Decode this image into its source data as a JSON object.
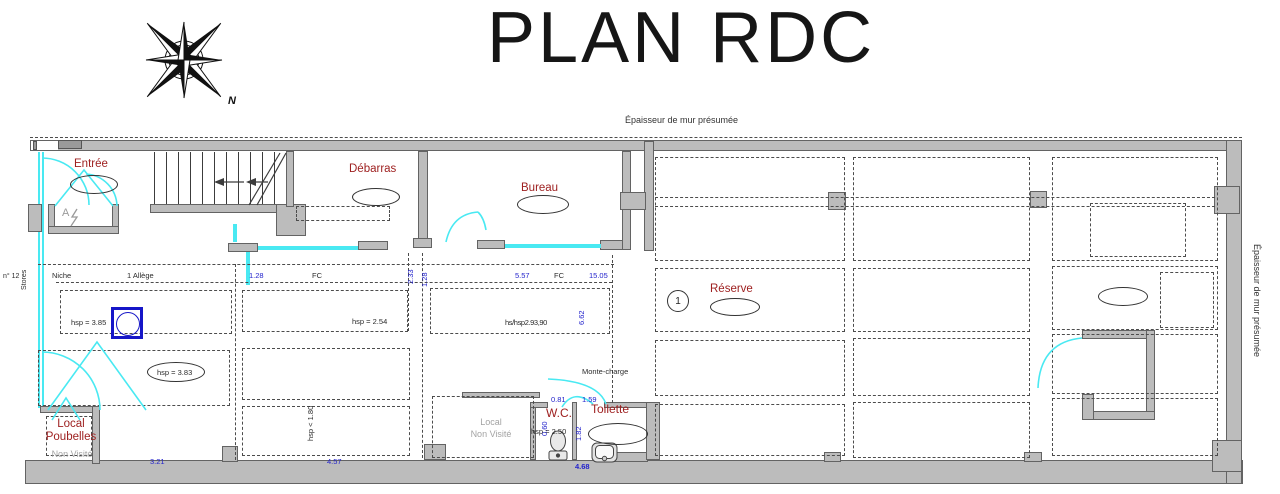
{
  "title": "PLAN RDC",
  "notes": {
    "top": "Épaisseur de mur présumée",
    "right": "Épaisseur de mur présumée"
  },
  "compass": {
    "north_label": "N"
  },
  "rooms": {
    "entree": {
      "label": "Entrée"
    },
    "debarras": {
      "label": "Débarras"
    },
    "bureau": {
      "label": "Bureau"
    },
    "reserve": {
      "label": "Réserve"
    },
    "wc": {
      "label": "W.C."
    },
    "toilette": {
      "label": "Toilette"
    },
    "local_poubelles": {
      "line1": "Local",
      "line2": "Poubelles",
      "status": "Non Visité"
    },
    "local_non_visite": {
      "line1": "Local",
      "line2": "Non Visité"
    }
  },
  "annotations": {
    "niche": "Niche",
    "allege": "1 Allège",
    "fc_left": "FC",
    "fc_right": "FC",
    "stores": "Stores",
    "n12": "n° 12",
    "monte_charge": "Monte-charge",
    "zone_marker": "1",
    "panel": "A",
    "hsp_385": "hsp = 3.85",
    "hsp_254": "hsp = 2.54",
    "hsp_383": "hsp = 3.83",
    "hsp_180": "hsp < 1.80",
    "hsp_250": "hsp = 2.50",
    "hsp_overlap": "hs/hsp2.93,90"
  },
  "dimensions": {
    "d128": "1.28",
    "d233": "2.33",
    "d128b": "1.28",
    "d557": "5.57",
    "d1505": "15.05",
    "d662": "6.62",
    "d081": "0.81",
    "d159": "1.59",
    "d060": "0.60",
    "d182": "1.82",
    "d468": "4.68",
    "d321": "3.21",
    "d457": "4.57"
  },
  "colors": {
    "room_label": "#9e2020",
    "dimension_blue": "#2323cc",
    "glazing_cyan": "#49e9f2",
    "wall_fill": "#bcbcbc",
    "icon_blue": "#1616c8"
  }
}
